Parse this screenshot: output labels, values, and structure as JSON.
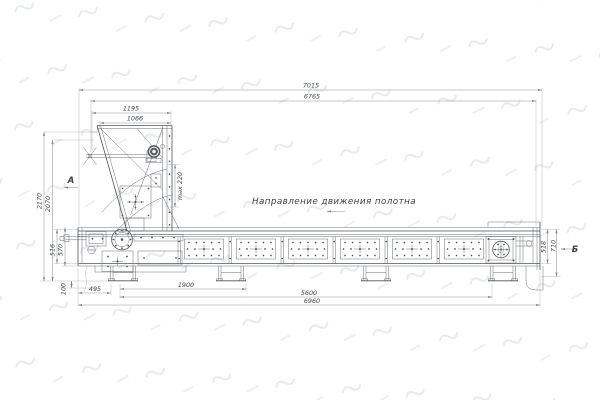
{
  "note": {
    "direction_label": "Направление движения полотна"
  },
  "views": {
    "a": "А",
    "b": "Б"
  },
  "dims": {
    "overall_top": "7015",
    "top_inner": "6765",
    "hopper_outer": "1195",
    "hopper_inner": "1066",
    "max_layer": "max 220",
    "height_outer": "2170",
    "height_inner": "2070",
    "frame_left_inner": "516",
    "frame_left_outer": "570",
    "ground_clearance": "100",
    "foot_offset": "495",
    "drive_section": "1900",
    "support_span": "5600",
    "overall_bottom": "6960",
    "frame_right_inner": "518",
    "frame_right_outer": "710"
  },
  "colors": {
    "line": "#4e545c",
    "dim_line": "#8f959d",
    "text": "#41464d",
    "watermark": "#e6ebf0",
    "background": "#ffffff"
  }
}
